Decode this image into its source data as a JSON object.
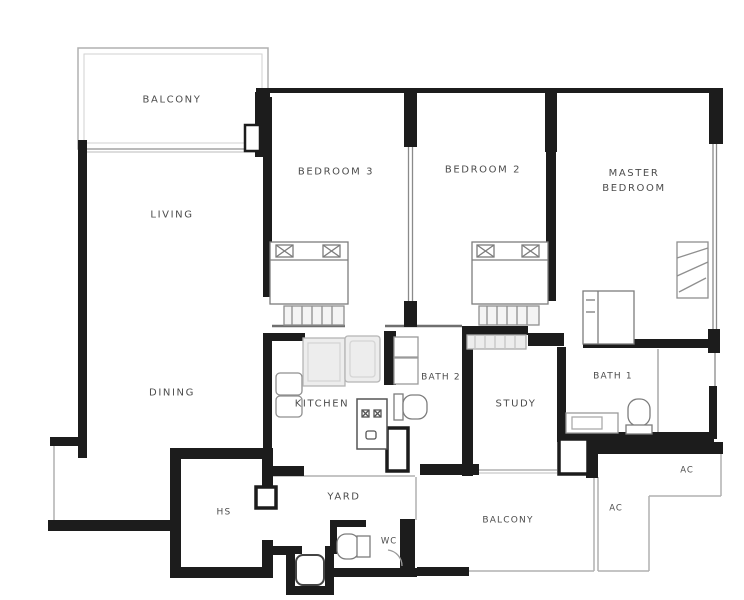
{
  "document": {
    "type": "apartment floor plan scan",
    "unit_rooms_count": 16
  },
  "labels": {
    "balcony_top": "BALCONY",
    "living": "LIVING",
    "dining": "DINING",
    "bedroom3": "BEDROOM  3",
    "bedroom2": "BEDROOM  2",
    "master_bedroom": "MASTER\nBEDROOM",
    "kitchen": "KITCHEN",
    "bath2": "BATH  2",
    "study": "STUDY",
    "bath1": "BATH  1",
    "yard": "YARD",
    "hs": "HS",
    "wc": "WC",
    "balcony_bottom": "BALCONY",
    "ac_upper": "AC",
    "ac_lower": "AC"
  },
  "colors": {
    "wall": "#1c1c1c",
    "interior_wall": "#6f6f6f",
    "window_line": "#b0b0b0",
    "furniture_line": "#8f8f8f",
    "counter_fill": "#ededed",
    "label_text": "#4c4c4c",
    "background": "#ffffff"
  }
}
